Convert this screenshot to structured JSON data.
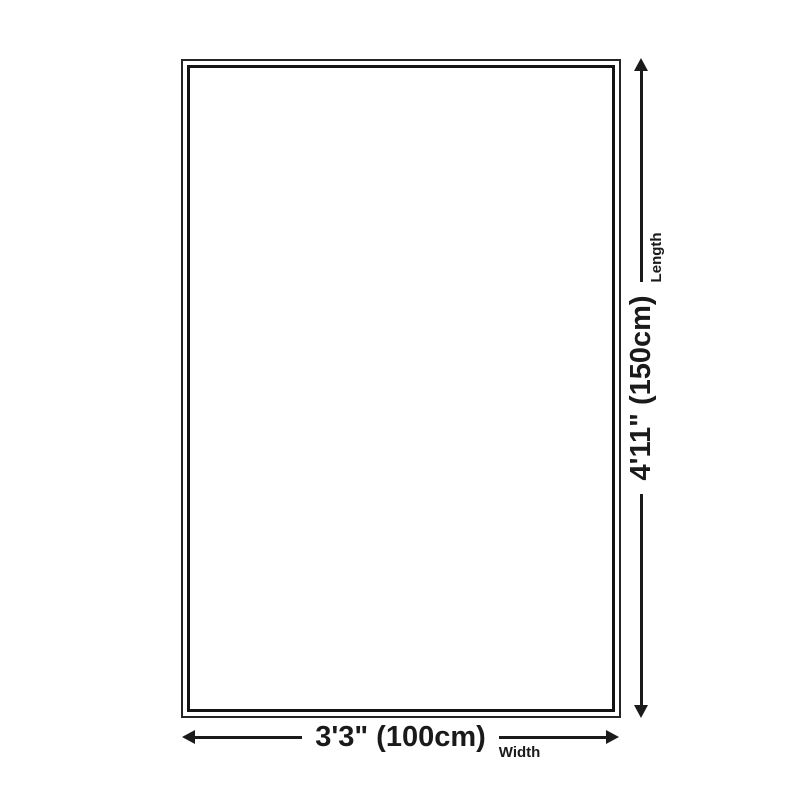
{
  "diagram": {
    "type": "product-dimension-diagram",
    "length": {
      "value": "4'11\" (150cm)",
      "axis_label": "Length"
    },
    "width": {
      "value": "3'3\" (100cm)",
      "axis_label": "Width"
    },
    "colors": {
      "background": "#ffffff",
      "line": "#1b1b1b",
      "text": "#1a1a1a",
      "border_outer": "#242424",
      "border_inner": "#141414"
    }
  }
}
